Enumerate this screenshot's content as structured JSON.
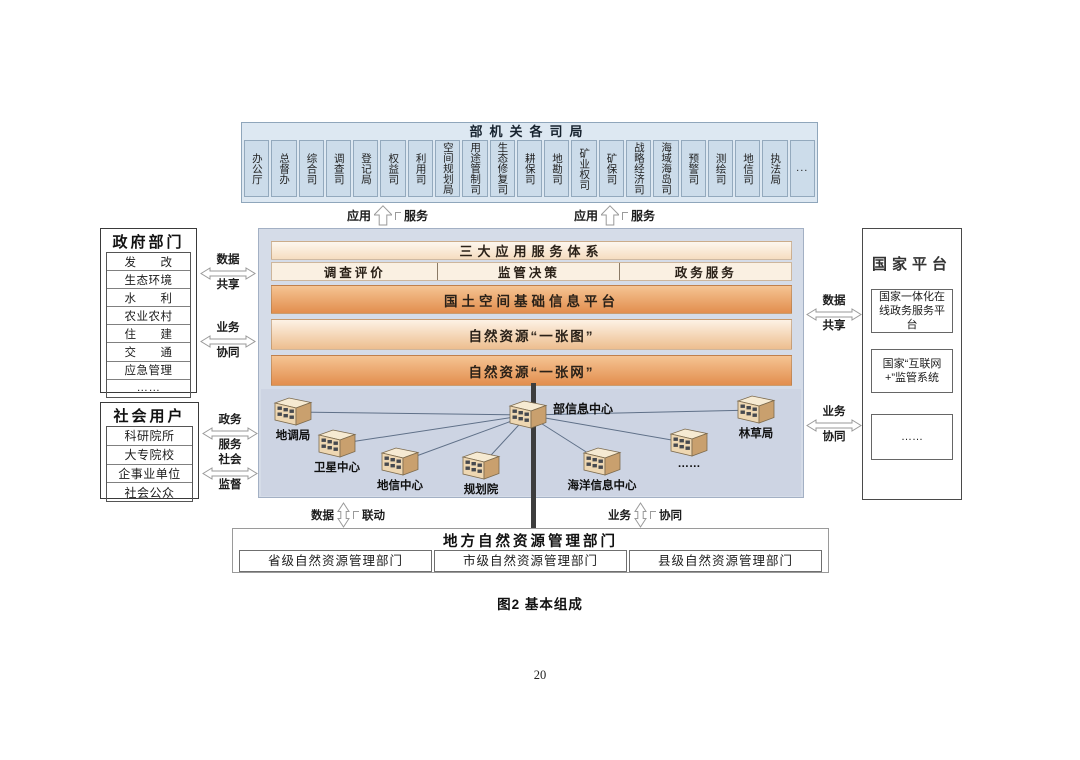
{
  "page": {
    "caption": "图2 基本组成",
    "page_number": "20"
  },
  "top_box": {
    "title": "部机关各司局",
    "departments": [
      "办公厅",
      "总督办",
      "综合司",
      "调查司",
      "登记局",
      "权益司",
      "利用司",
      "空间规划局",
      "用途管制司",
      "生态修复司",
      "耕保司",
      "地勘司",
      "矿业权司",
      "矿保司",
      "战略经济司",
      "海域海岛司",
      "预警司",
      "测绘司",
      "地信司",
      "执法局",
      "..."
    ]
  },
  "top_arrows": [
    {
      "left": "应用",
      "right": "服务"
    },
    {
      "left": "应用",
      "right": "服务"
    }
  ],
  "gov_box": {
    "title": "政府部门",
    "rows": [
      "发　　改",
      "生态环境",
      "水　　利",
      "农业农村",
      "住　　建",
      "交　　通",
      "应急管理",
      "……"
    ]
  },
  "social_box": {
    "title": "社会用户",
    "rows": [
      "科研院所",
      "大专院校",
      "企事业单位",
      "社会公众"
    ]
  },
  "left_arrows": [
    {
      "top": "数据",
      "bottom": "共享"
    },
    {
      "top": "业务",
      "bottom": "协同"
    },
    {
      "top": "政务",
      "bottom": "服务"
    },
    {
      "top": "社会",
      "bottom": "监督"
    }
  ],
  "center_stack": {
    "title": "三大应用服务体系",
    "services": [
      "调查评价",
      "监管决策",
      "政务服务"
    ],
    "platform": "国土空间基础信息平台",
    "one_map": "自然资源“一张图”",
    "one_net": "自然资源“一张网”"
  },
  "network": {
    "hub": "部信息中心",
    "nodes": [
      "地调局",
      "卫星中心",
      "地信中心",
      "规划院",
      "海洋信息中心",
      "……",
      "林草局"
    ]
  },
  "national_box": {
    "title": "国家平台",
    "items": [
      "国家一体化在线政务服务平台",
      "国家“互联网+”监管系统",
      "……"
    ]
  },
  "right_arrows": [
    {
      "top": "数据",
      "bottom": "共享"
    },
    {
      "top": "业务",
      "bottom": "协同"
    }
  ],
  "bottom_arrows": [
    {
      "left": "数据",
      "right": "联动"
    },
    {
      "left": "业务",
      "right": "协同"
    }
  ],
  "bottom_box": {
    "title": "地方自然资源管理部门",
    "cells": [
      "省级自然资源管理部门",
      "市级自然资源管理部门",
      "县级自然资源管理部门"
    ]
  },
  "colors": {
    "band_orange_top": "#f5c493",
    "band_orange_bottom": "#e28e4e",
    "band_cream": "#faf0e2",
    "panel_bg": "#d5dce8",
    "network_bg": "#cdd4e3",
    "topbox_cell": "#ccdcea",
    "icon_front": "#eed7b2",
    "icon_side": "#c9a06e",
    "icon_top": "#f6ead2",
    "thick_line": "#3d3d3d"
  }
}
